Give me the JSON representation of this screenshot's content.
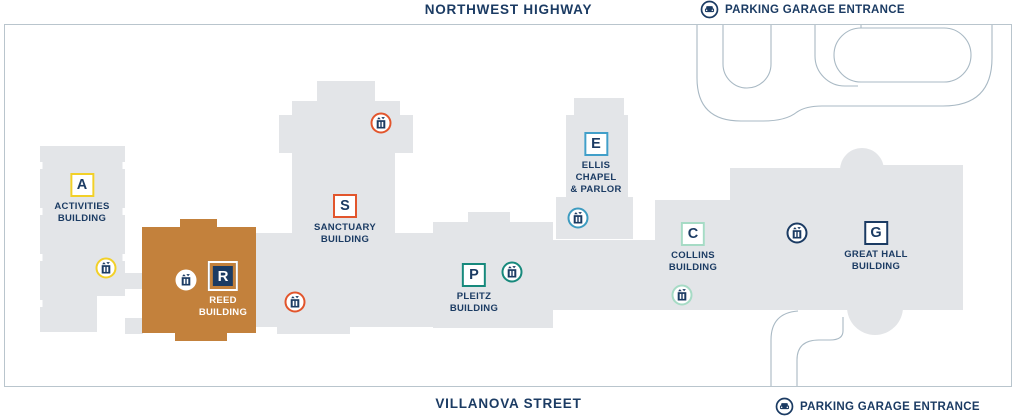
{
  "map": {
    "streets": {
      "top": "NORTHWEST HIGHWAY",
      "bottom": "VILLANOVA STREET"
    },
    "parking_entrances": [
      {
        "position": "top-right",
        "label": "PARKING GARAGE ENTRANCE"
      },
      {
        "position": "bottom-right",
        "label": "PARKING GARAGE ENTRANCE"
      }
    ]
  },
  "buildings": [
    {
      "letter": "A",
      "name": "ACTIVITIES\nBUILDING",
      "accent": "#f2d028",
      "highlighted": false
    },
    {
      "letter": "R",
      "name": "REED\nBUILDING",
      "accent": "#ffffff",
      "highlighted": true,
      "fill": "#c3813c"
    },
    {
      "letter": "S",
      "name": "SANCTUARY\nBUILDING",
      "accent": "#e2552c",
      "highlighted": false
    },
    {
      "letter": "P",
      "name": "PLEITZ\nBUILDING",
      "accent": "#17897c",
      "highlighted": false
    },
    {
      "letter": "E",
      "name": "ELLIS\nCHAPEL\n& PARLOR",
      "accent": "#419fc9",
      "highlighted": false
    },
    {
      "letter": "C",
      "name": "COLLINS\nBUILDING",
      "accent": "#a6dbc5",
      "highlighted": false
    },
    {
      "letter": "G",
      "name": "GREAT HALL\nBUILDING",
      "accent": "#1b3b63",
      "highlighted": false
    }
  ],
  "elevators": [
    {
      "location": "activities-building",
      "color": "#f2d028",
      "x": 106,
      "y": 268
    },
    {
      "location": "reed-building",
      "color": "#ffffff",
      "x": 186,
      "y": 280
    },
    {
      "location": "reed-sanctuary-corridor",
      "color": "#e2552c",
      "x": 295,
      "y": 302
    },
    {
      "location": "sanctuary-building",
      "color": "#e2552c",
      "x": 381,
      "y": 123
    },
    {
      "location": "pleitz-building",
      "color": "#17897c",
      "x": 512,
      "y": 272
    },
    {
      "location": "ellis-chapel",
      "color": "#3d9bc0",
      "x": 578,
      "y": 218
    },
    {
      "location": "collins-building",
      "color": "#a6dbc5",
      "x": 682,
      "y": 295
    },
    {
      "location": "great-hall-building",
      "color": "#1b3b63",
      "x": 797,
      "y": 233
    }
  ],
  "palette": {
    "navy_text": "#1b3b63",
    "building_gray": "#e3e5e8",
    "highlight_orange": "#c3813c",
    "road_line": "#a9b9c4",
    "map_border": "#b9c5cd"
  }
}
